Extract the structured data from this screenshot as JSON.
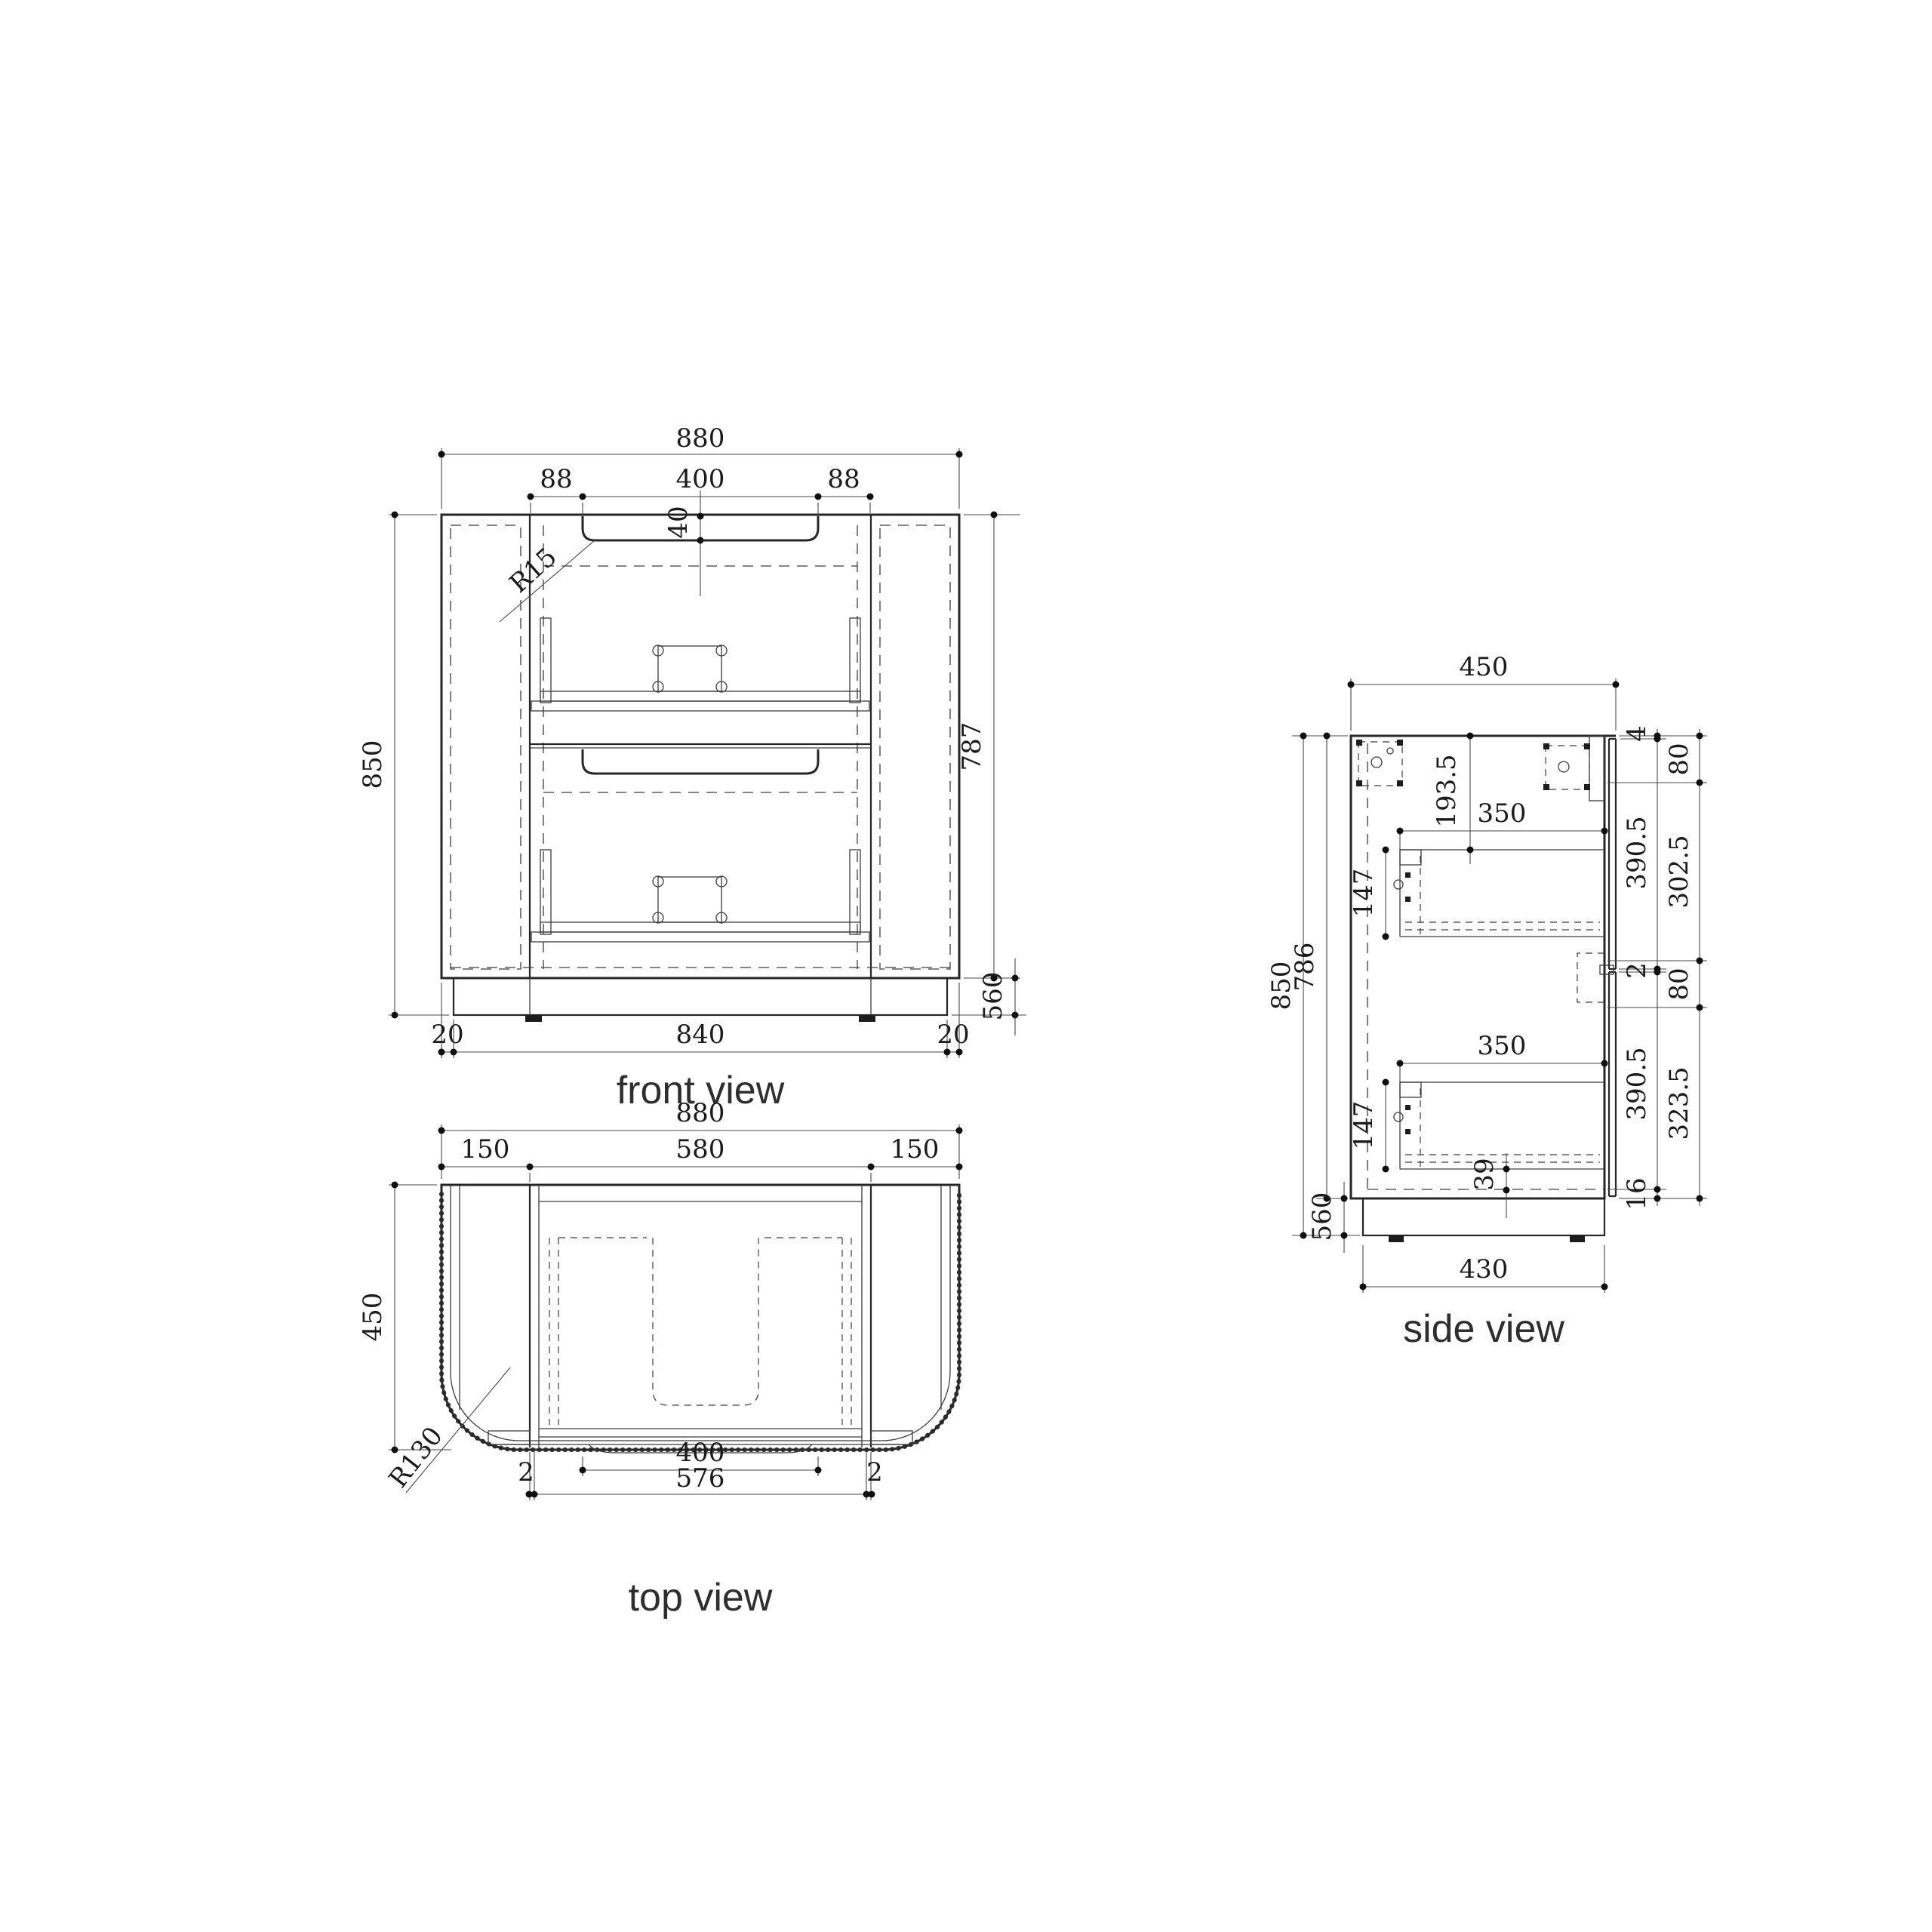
{
  "drawing": {
    "background": "#ffffff",
    "line_color": "#262626",
    "views": {
      "front": {
        "title": "front view",
        "dims": {
          "overall_width": "880",
          "handle_offset_left": "88",
          "handle_width": "400",
          "handle_offset_right": "88",
          "handle_depth": "40",
          "handle_radius": "R15",
          "overall_height": "850",
          "body_height": "787",
          "plinth_height": "560",
          "plinth_inset_left": "20",
          "plinth_width": "840",
          "plinth_inset_right": "20"
        }
      },
      "top": {
        "title": "top view",
        "dims": {
          "overall_width": "880",
          "side_panel_left": "150",
          "inner_width": "580",
          "side_panel_right": "150",
          "overall_depth": "450",
          "corner_radius": "R130",
          "handle_width": "400",
          "drawer_front_width": "576",
          "gap_left": "2",
          "gap_right": "2"
        }
      },
      "side": {
        "title": "side view",
        "dims": {
          "overall_depth": "450",
          "top_gap": "4",
          "bracket_zone_top": "80",
          "drawer_top_offset": "193.5",
          "drawer_depth_upper": "350",
          "drawer_front_upper": "390.5",
          "runner_zone_upper": "302.5",
          "drawer_height_upper": "147",
          "front_gap": "2",
          "bracket_zone_mid": "80",
          "overall_height": "850",
          "body_height": "786",
          "drawer_depth_lower": "350",
          "drawer_front_lower": "390.5",
          "runner_zone_lower": "323.5",
          "drawer_height_lower": "147",
          "bottom_clearance": "39",
          "bottom_panel": "16",
          "plinth_height": "560",
          "plinth_depth": "430"
        }
      }
    }
  }
}
